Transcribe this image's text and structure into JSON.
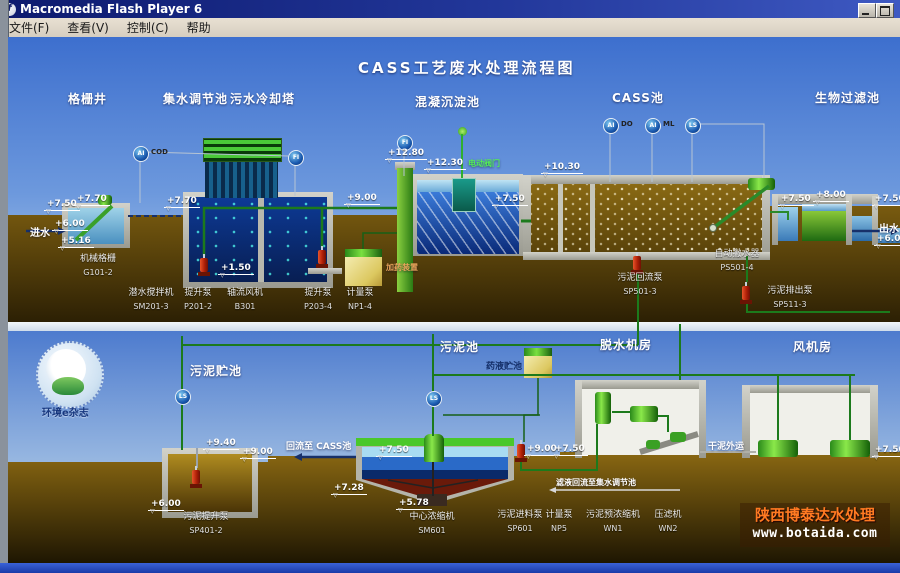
{
  "window": {
    "title": "Macromedia Flash Player 6",
    "menu": [
      "文件(F)",
      "查看(V)",
      "控制(C)",
      "帮助"
    ]
  },
  "diagram": {
    "title": "CASS工艺废水处理流程图",
    "top_labels": {
      "grid_well": "格栅井",
      "collection_tank": "集水调节池",
      "cooling_tower": "污水冷却塔",
      "coagulation_tank": "混凝沉淀池",
      "cass_tank": "CASS池",
      "biofilter": "生物过滤池"
    },
    "bottom_labels": {
      "sludge_storage": "污泥贮池",
      "sludge_tank": "污泥池",
      "dewatering_room": "脱水机房",
      "blower_room": "风机房"
    },
    "flows": {
      "inlet": "进水",
      "outlet": "出水",
      "return_to_cass": "回流至 CASS池",
      "dry_sludge": "干泥外运",
      "filtrate": "滤液回流至集水调节池",
      "dosing": "加药装置",
      "chem_tank": "药液贮池",
      "valve": "电动阀门"
    },
    "equipment": [
      {
        "name": "机械格栅",
        "code": "G101-2"
      },
      {
        "name": "潜水搅拌机",
        "code": "SM201-3"
      },
      {
        "name": "提升泵",
        "code": "P201-2"
      },
      {
        "name": "轴流风机",
        "code": "B301"
      },
      {
        "name": "提升泵",
        "code": "P203-4"
      },
      {
        "name": "计量泵",
        "code": "NP1-4"
      },
      {
        "name": "自动撇水器",
        "code": "PS501-4"
      },
      {
        "name": "污泥回流泵",
        "code": "SP501-3"
      },
      {
        "name": "污泥排出泵",
        "code": "SP511-3"
      },
      {
        "name": "污泥提升泵",
        "code": "SP401-2"
      },
      {
        "name": "中心浓缩机",
        "code": "SM601"
      },
      {
        "name": "污泥进料泵",
        "code": "SP601"
      },
      {
        "name": "计量泵",
        "code": "NP5"
      },
      {
        "name": "污泥预浓缩机",
        "code": "WN1"
      },
      {
        "name": "压滤机",
        "code": "WN2"
      }
    ],
    "elevations": [
      "+7.50",
      "+7.70",
      "+6.00",
      "+5.16",
      "+7.70",
      "+1.50",
      "+9.00",
      "+12.80",
      "+12.30",
      "+7.50",
      "+10.30",
      "+7.50",
      "+8.00",
      "+7.50",
      "+6.00",
      "+9.40",
      "+9.00",
      "+6.00",
      "+7.50",
      "+7.28",
      "+5.78",
      "+9.00",
      "+7.50",
      "+7.50"
    ],
    "instruments": [
      {
        "tag": "AI",
        "sub": "COD"
      },
      {
        "tag": "FI",
        "sub": ""
      },
      {
        "tag": "FI",
        "sub": ""
      },
      {
        "tag": "AI",
        "sub": "DO"
      },
      {
        "tag": "AI",
        "sub": "ML"
      },
      {
        "tag": "LS",
        "sub": ""
      },
      {
        "tag": "LS",
        "sub": ""
      },
      {
        "tag": "LS",
        "sub": ""
      }
    ],
    "logo_text": "环境e杂志",
    "watermark": {
      "line1": "陕西博泰达水处理",
      "line2": "www.botaida.com"
    }
  }
}
